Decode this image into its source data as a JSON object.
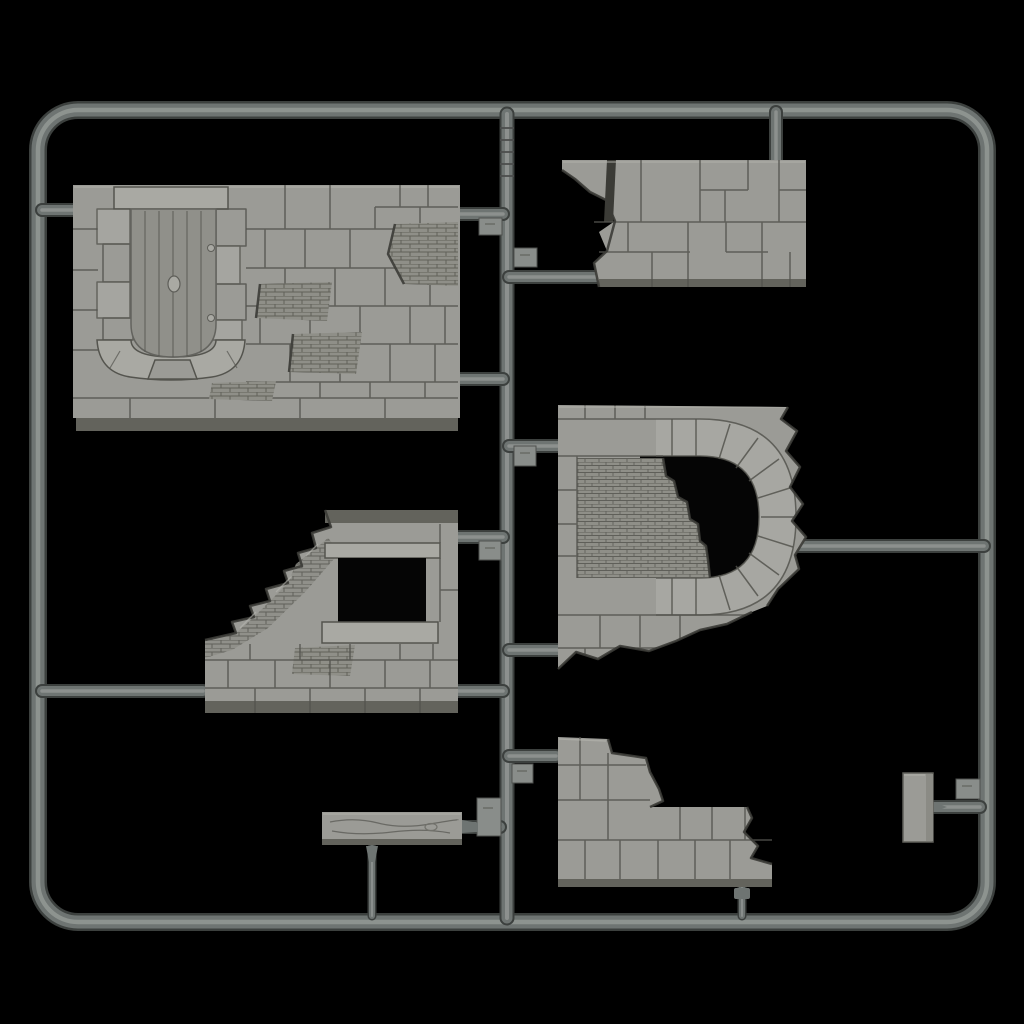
{
  "scene": {
    "description": "Photograph of a gray plastic model-kit sprue holding seven ruined stone-wall diorama parts on a black background",
    "background_color": "#000000",
    "plastic_color_name": "light gray styrene"
  },
  "colors": {
    "bg": "#000000",
    "tube_edge": "#3c403e",
    "tube_mid": "#6e7472",
    "tube_hi": "#989d9a",
    "part_face": "#9b9b96",
    "part_face_light": "#a9a9a3",
    "door_face": "#90908a",
    "part_side": "#63635c",
    "mortar": "#54544e",
    "brick_patch": "#8f8f88",
    "opening_black": "#050505",
    "nub": "#898d8a",
    "edge_highlight": "#b5b5af"
  },
  "sprue": {
    "frame_shape": "rounded rectangle runner frame",
    "runner_tab_count": 7,
    "parts": [
      {
        "id": "1",
        "name": "wall with arched plank door",
        "description": "Large stone wall, planked arched doorway with knob, quoins and brick patches"
      },
      {
        "id": "2",
        "name": "broken wall top section",
        "description": "Two courses of large stones with ragged left break and crack"
      },
      {
        "id": "3",
        "name": "wall with arched opening",
        "description": "Stone wall with D-shaped arch partly bricked in, ragged right and bottom edges"
      },
      {
        "id": "4",
        "name": "ruined wall with window",
        "description": "Wall with square window, lintel and sill, collapsed diagonal upper-left edge"
      },
      {
        "id": "5",
        "name": "wooden plank",
        "description": "Flat plank with wood grain and knot"
      },
      {
        "id": "6",
        "name": "stepped ruined wall",
        "description": "Corner wall stepping down to the right with ragged break"
      },
      {
        "id": "7",
        "name": "small flat block",
        "description": "Small rectangular flat accessory part"
      }
    ]
  }
}
